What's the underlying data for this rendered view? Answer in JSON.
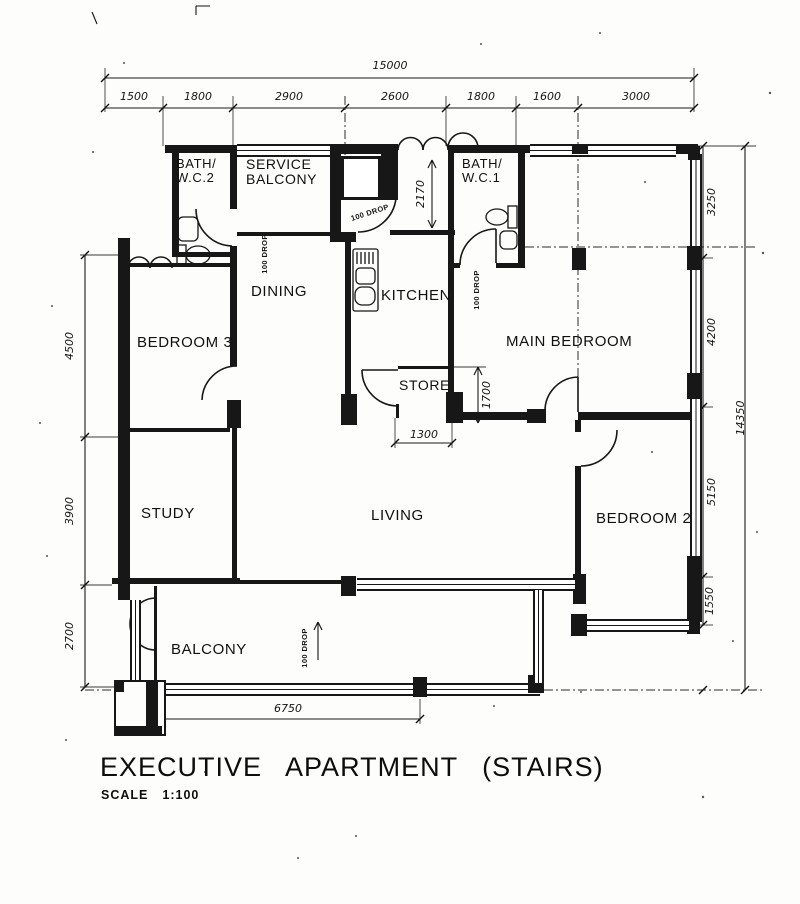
{
  "title": {
    "main": "EXECUTIVE  APARTMENT  (STAIRS)",
    "scale_label": "SCALE",
    "scale_value": "1:100"
  },
  "rooms": [
    {
      "id": "bath-wc2",
      "line1": "BATH/",
      "line2": "W.C.2"
    },
    {
      "id": "service-balcony",
      "line1": "SERVICE",
      "line2": "BALCONY"
    },
    {
      "id": "bath-wc1",
      "line1": "BATH/",
      "line2": "W.C.1"
    },
    {
      "id": "dining",
      "label": "DINING"
    },
    {
      "id": "kitchen",
      "label": "KITCHEN"
    },
    {
      "id": "main-bedroom",
      "label": "MAIN BEDROOM"
    },
    {
      "id": "bedroom-3",
      "label": "BEDROOM 3"
    },
    {
      "id": "store",
      "label": "STORE"
    },
    {
      "id": "study",
      "label": "STUDY"
    },
    {
      "id": "living",
      "label": "LIVING"
    },
    {
      "id": "bedroom-2",
      "label": "BEDROOM 2"
    },
    {
      "id": "balcony",
      "label": "BALCONY"
    }
  ],
  "dimensions": {
    "top_total": "15000",
    "top_segments": [
      "1500",
      "1800",
      "2900",
      "2600",
      "1800",
      "1600",
      "3000"
    ],
    "left_segments": [
      "4500",
      "3900",
      "2700"
    ],
    "right_segments": [
      "3250",
      "4200",
      "5150",
      "1550"
    ],
    "right_total": "14350",
    "bottom_width": "6750",
    "entry_depth": "2170",
    "store_depth": "1700",
    "store_width": "1300"
  },
  "annotations": {
    "drop_service": "100 DROP",
    "drop_entry": "100 DROP",
    "drop_bath1": "100 DROP",
    "drop_balcony": "100 DROP"
  }
}
